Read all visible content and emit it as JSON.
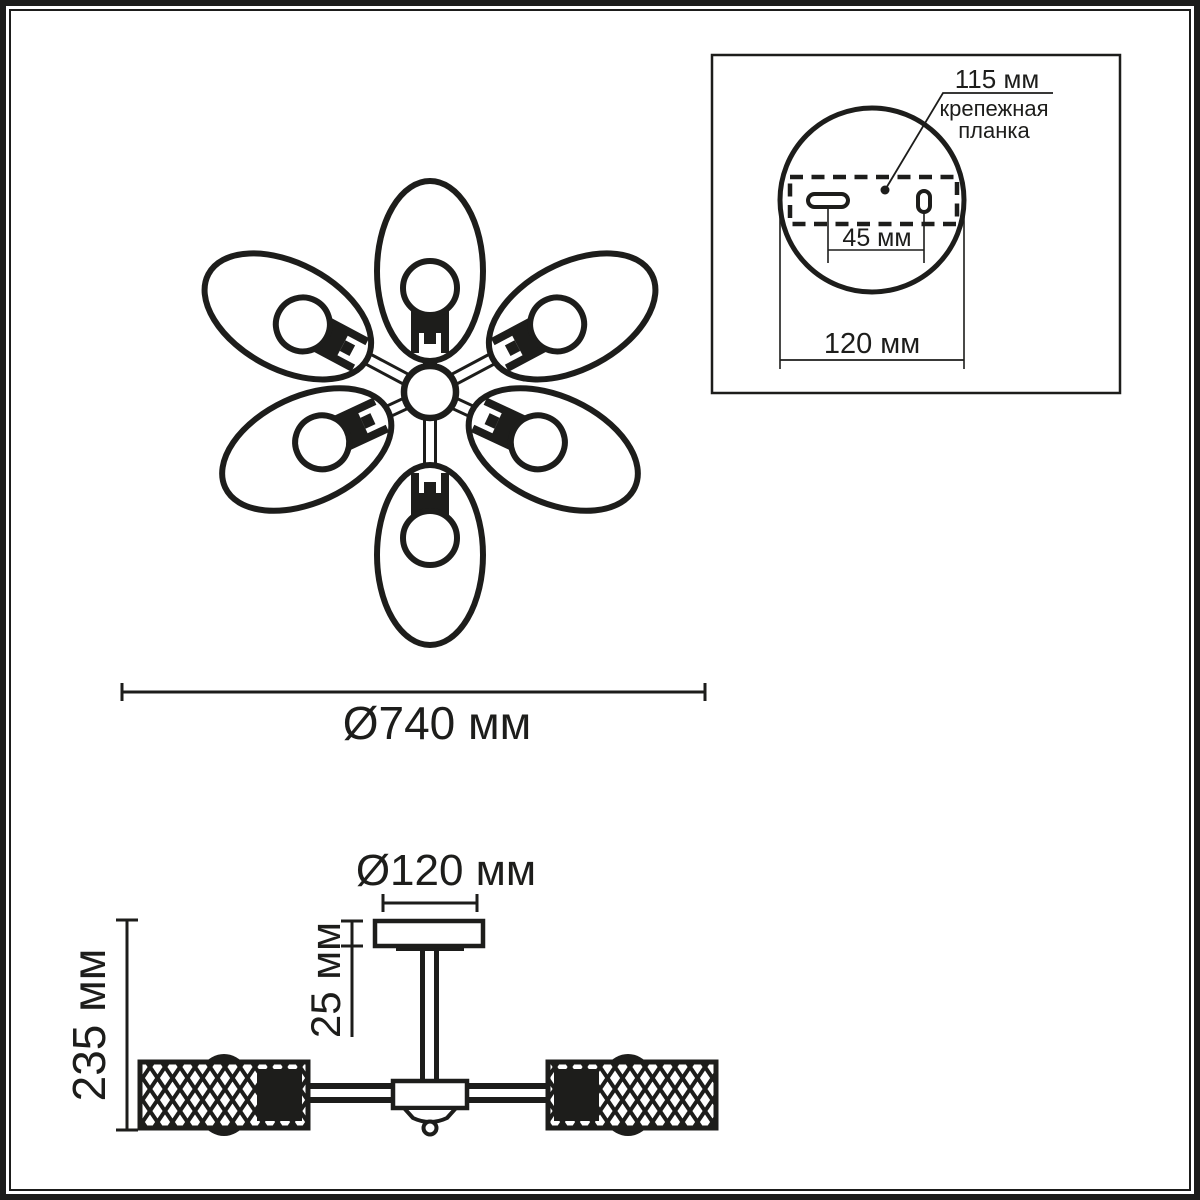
{
  "page": {
    "background_color": "#ffffff",
    "ink_color": "#1d1d1b",
    "type": "lighting fixture dimension drawing"
  },
  "top_view": {
    "diameter_label": "Ø740 мм",
    "shade_count": 6
  },
  "mount_inset": {
    "plate_length_label": "115 мм",
    "plate_caption_line1": "крепежная",
    "plate_caption_line2": "планка",
    "hole_spacing_label": "45 мм",
    "base_diameter_label": "120 мм"
  },
  "side_view": {
    "canopy_diameter_label": "Ø120 мм",
    "canopy_height_label": "25 мм",
    "overall_height_label": "235 мм"
  }
}
